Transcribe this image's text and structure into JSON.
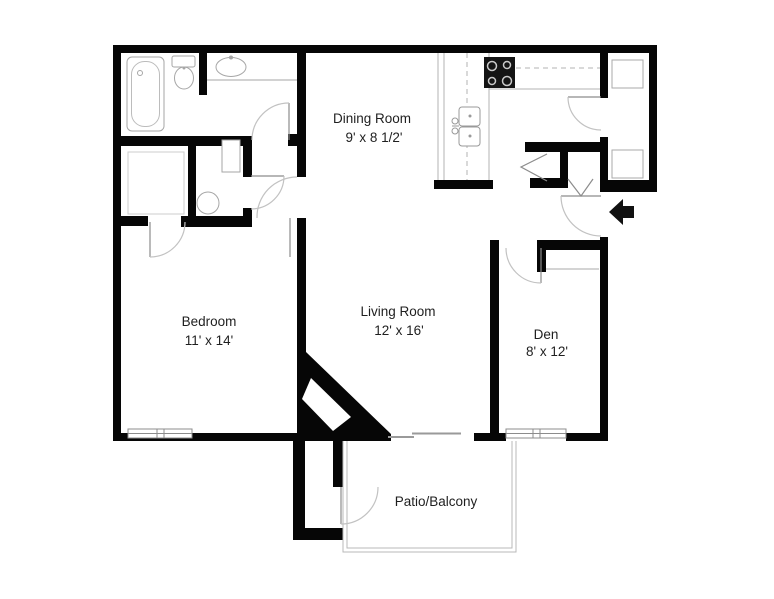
{
  "title": "Apartment floor plan",
  "rooms": {
    "dining": {
      "name": "Dining Room",
      "dims": "9' x 8 1/2'"
    },
    "bedroom": {
      "name": "Bedroom",
      "dims": "11' x 14'"
    },
    "living": {
      "name": "Living Room",
      "dims": "12' x 16'"
    },
    "den": {
      "name": "Den",
      "dims": "8' x 12'"
    },
    "patio": {
      "name": "Patio/Balcony"
    }
  },
  "fixtures": [
    "bathtub",
    "toilet",
    "vanity-sink",
    "hall-bath-toilet",
    "hall-bath-vanity",
    "kitchen-double-sink",
    "stove-cooktop",
    "fireplace",
    "washer-dryer-shelves",
    "bifold-closet-doors",
    "entry-arrow",
    "patio-outline",
    "windows",
    "sliding-glass-door"
  ],
  "colors": {
    "wall": "#000000",
    "fixture_stroke": "#a6a6a6",
    "door_arc": "#c2c2c2",
    "text": "#1f1f1f",
    "background": "#ffffff"
  }
}
